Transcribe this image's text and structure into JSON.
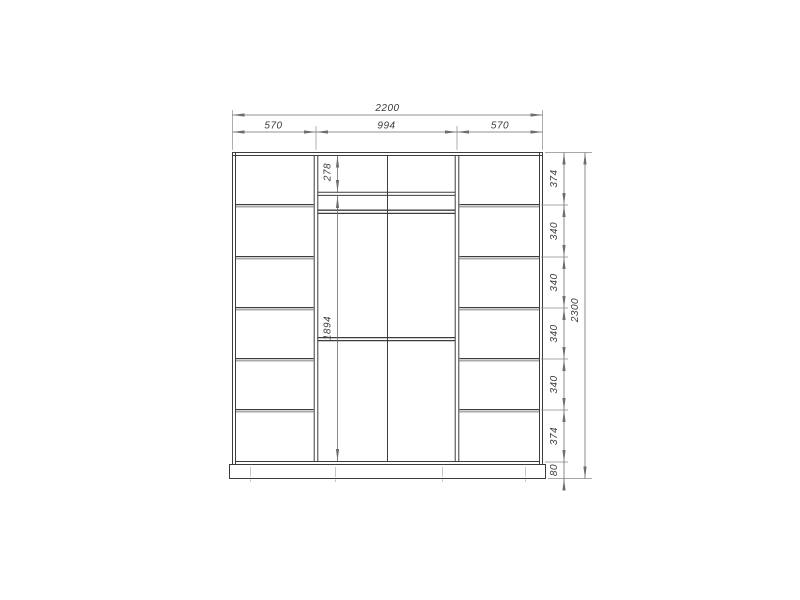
{
  "drawing": {
    "dimensions": {
      "width_total": "2200",
      "width_segments": [
        "570",
        "994",
        "570"
      ],
      "height_total": "2300",
      "height_segments": [
        "374",
        "340",
        "340",
        "340",
        "340",
        "374",
        "80"
      ],
      "top_compartment_height": "278",
      "main_compartment_height": "1894"
    },
    "colors": {
      "background": "#ffffff",
      "line": "#3d3d3d",
      "dim_line": "#6e6e6e",
      "ext_line": "#8a8a8a",
      "shelf_gray": "#a8a8a8",
      "text": "#3a3a3a"
    }
  }
}
